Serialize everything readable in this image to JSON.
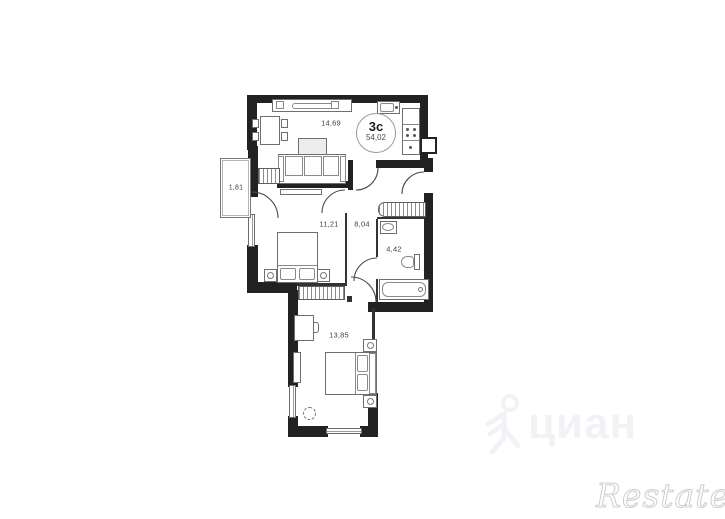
{
  "page": {
    "background": "#ffffff"
  },
  "plan": {
    "badge": {
      "type_label": "3с",
      "total_area": "54,02"
    },
    "rooms": {
      "living_kitchen": {
        "area": "14,69"
      },
      "balcony": {
        "area": "1,81"
      },
      "bedroom1": {
        "area": "11,21"
      },
      "hallway": {
        "area": "8,04"
      },
      "bathroom": {
        "area": "4,42"
      },
      "bedroom2": {
        "area": "13,85"
      }
    },
    "colors": {
      "wall": "#222222",
      "furniture_line": "#6e6e6e",
      "label_text": "#3f3f3f",
      "badge_border": "#9a9a9a"
    }
  },
  "watermarks": {
    "cian": {
      "text": "циан",
      "color": "#e7e9ef"
    },
    "restate": {
      "text": "Restate",
      "color": "#cdcdd0"
    }
  }
}
